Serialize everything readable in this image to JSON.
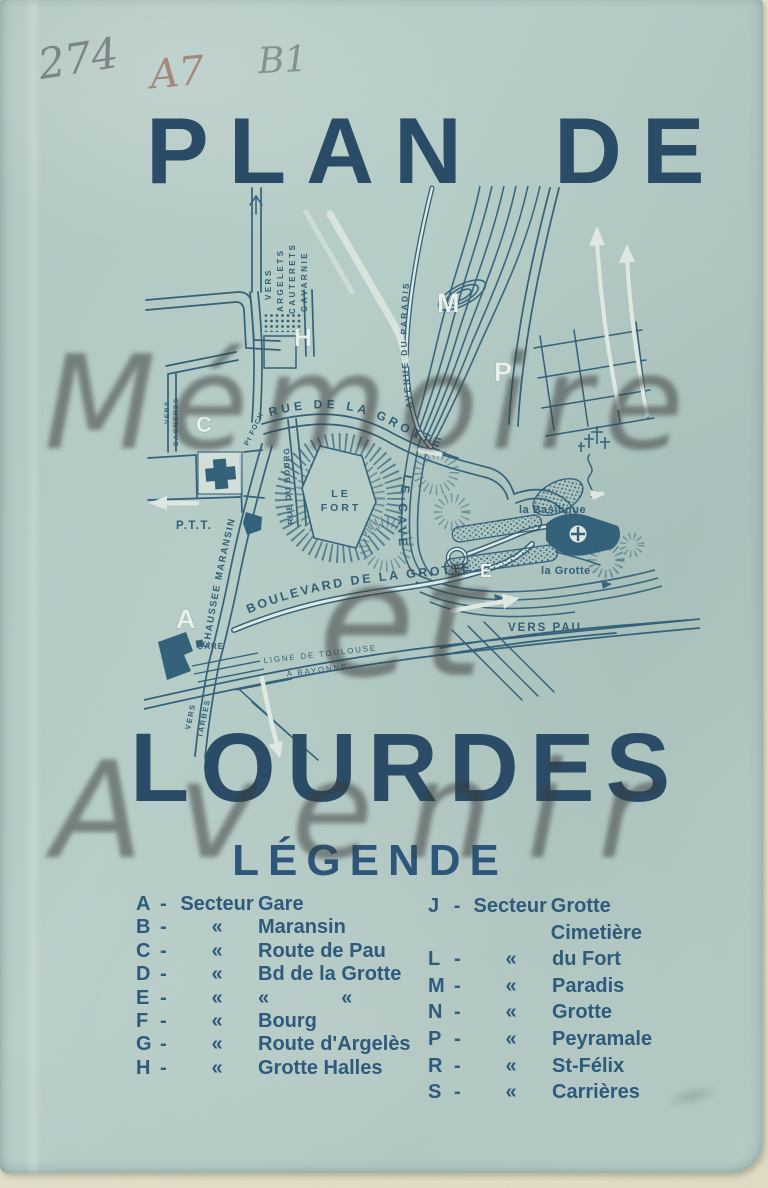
{
  "annotations": {
    "archive_number": "274",
    "code_a": "A7",
    "code_b": "B1"
  },
  "titles": {
    "top": "PLAN DE",
    "bottom": "LOURDES"
  },
  "watermark": {
    "line1": "Mémoire",
    "line2": "et",
    "line3": "Avenir"
  },
  "legend": {
    "heading": "LÉGENDE",
    "left": [
      {
        "letter": "A",
        "dash": "-",
        "prefix": "Secteur",
        "label": "Gare"
      },
      {
        "letter": "B",
        "dash": "-",
        "prefix": "«",
        "label": "Maransin"
      },
      {
        "letter": "C",
        "dash": "-",
        "prefix": "«",
        "label": "Route de Pau"
      },
      {
        "letter": "D",
        "dash": "-",
        "prefix": "«",
        "label": "Bd de la Grotte"
      },
      {
        "letter": "E",
        "dash": "-",
        "prefix": "«",
        "label": "«",
        "label2": "«"
      },
      {
        "letter": "F",
        "dash": "-",
        "prefix": "«",
        "label": "Bourg"
      },
      {
        "letter": "G",
        "dash": "-",
        "prefix": "«",
        "label": "Route d'Argelès"
      },
      {
        "letter": "H",
        "dash": "-",
        "prefix": "«",
        "label": "Grotte Halles"
      }
    ],
    "right": [
      {
        "letter": "J",
        "dash": "-",
        "prefix": "Secteur",
        "label": "Grotte Cimetière"
      },
      {
        "letter": "L",
        "dash": "-",
        "prefix": "«",
        "label": "du Fort"
      },
      {
        "letter": "M",
        "dash": "-",
        "prefix": "«",
        "label": "Paradis"
      },
      {
        "letter": "N",
        "dash": "-",
        "prefix": "«",
        "label": "Grotte"
      },
      {
        "letter": "P",
        "dash": "-",
        "prefix": "«",
        "label": "Peyramale"
      },
      {
        "letter": "R",
        "dash": "-",
        "prefix": "«",
        "label": "St-Félix"
      },
      {
        "letter": "S",
        "dash": "-",
        "prefix": "«",
        "label": "Carrières"
      }
    ]
  },
  "map": {
    "labels": {
      "vers1": "VERS",
      "argelets": "ARGELETS",
      "cauterets": "CAUTERETS",
      "gavarnie": "GAVARNIE",
      "vers2": "VERS",
      "bagneres": "BAGNERES",
      "avenue_paradis": "AVENUE DU PARADIS",
      "rue_grotte": "RUE DE LA GROTTE",
      "foch": "Pt FOCH",
      "rue_bourg": "RUE DU BOURG",
      "maransin": "CHAUSSEE MARANSIN",
      "gave": "LE GAVE",
      "fort_l1": "LE",
      "fort_l2": "FORT",
      "ptt": "P.T.T.",
      "basilique": "la Basilique",
      "grotte": "la Grotte",
      "vers_pau": "VERS PAU",
      "ligne": "LIGNE DE TOULOUSE",
      "bayonne": "A BAYONNE",
      "vers3": "VERS",
      "tarbes": "TARBES",
      "gare": "GARE"
    },
    "sectors": {
      "a": "A",
      "c": "C",
      "e": "E",
      "h": "H",
      "m": "M",
      "p": "P"
    },
    "colors": {
      "ink": "#2f5f78",
      "paper": "#b4cac5",
      "white_road": "#e3ebe4",
      "title_ink": "#2b4c66",
      "watermark_gray": "#393c3c",
      "paper_edge": "#e9e5d1"
    }
  }
}
